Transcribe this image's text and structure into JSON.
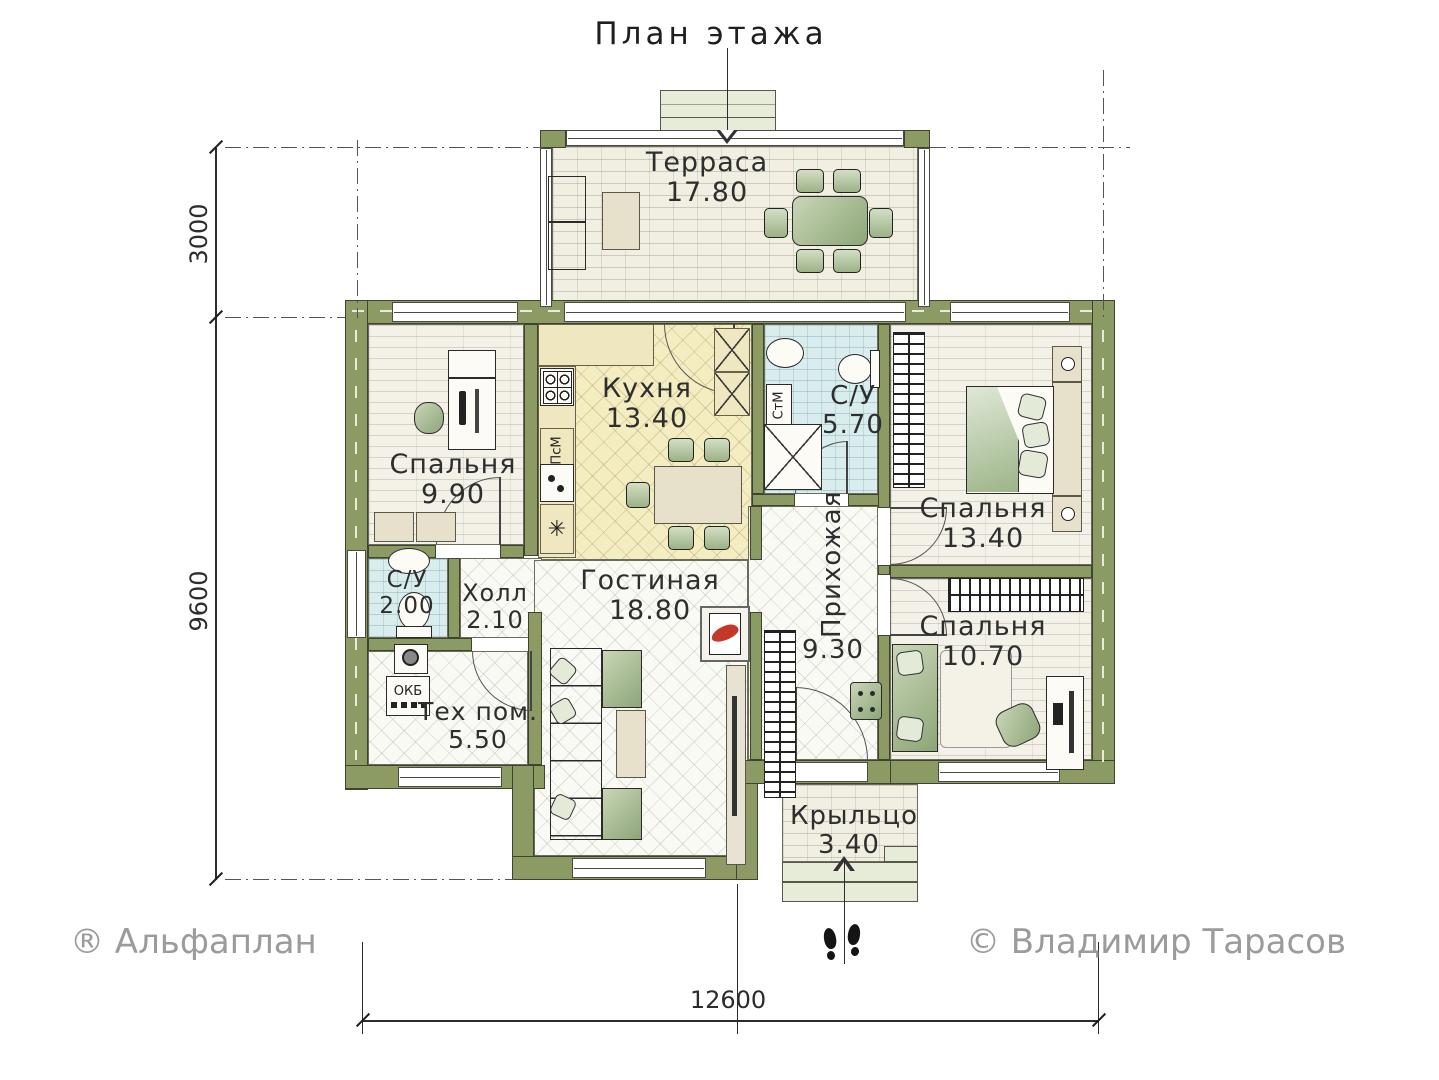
{
  "title": "План этажа",
  "credits": {
    "brand": "® Альфаплан",
    "author": "© Владимир Тарасов"
  },
  "dimensions": {
    "terrace_depth_mm": "3000",
    "house_depth_mm": "9600",
    "house_width_mm": "12600"
  },
  "rooms": [
    {
      "name": "Терраса",
      "area": "17.80"
    },
    {
      "name": "Кухня",
      "area": "13.40"
    },
    {
      "name": "С/У",
      "area": "5.70"
    },
    {
      "name": "Спальня",
      "area": "13.40"
    },
    {
      "name": "Спальня",
      "area": "9.90"
    },
    {
      "name": "Холл",
      "area": "2.10"
    },
    {
      "name": "С/У",
      "area": "2.00"
    },
    {
      "name": "Тех пом.",
      "area": "5.50"
    },
    {
      "name": "Гостиная",
      "area": "18.80"
    },
    {
      "name": "Прихожая",
      "area": "9.30"
    },
    {
      "name": "Спальня",
      "area": "10.70"
    },
    {
      "name": "Крыльцо",
      "area": "3.40"
    }
  ],
  "appliances": {
    "dishwasher": "ПсМ",
    "washing_machine": "СтМ",
    "boiler": "ОКБ"
  },
  "icons": {
    "fridge": "✳"
  },
  "colors": {
    "wall": "#8c9a63",
    "kitchen_floor": "#f4edc2",
    "bath_floor": "#d9edee",
    "accent_flame": "#c53726"
  }
}
